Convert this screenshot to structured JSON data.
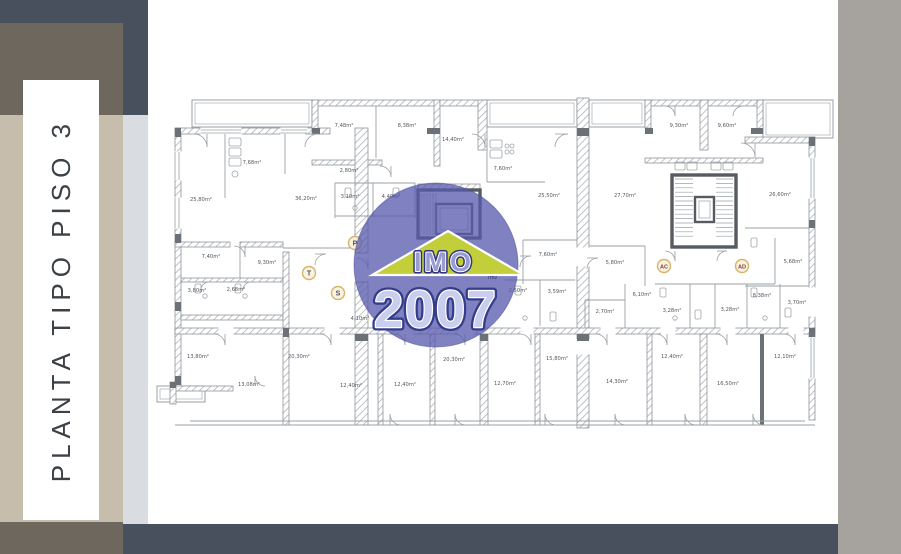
{
  "sidebar": {
    "title": "PLANTA TIPO PISO 3"
  },
  "watermark": {
    "brand_top": "IMO",
    "brand_year": "2007",
    "brand_small": "rmv",
    "circle_color": "#585aac",
    "house_color": "#c9d62f"
  },
  "plan": {
    "unit_badges": [
      {
        "label": "P",
        "x": 200,
        "y": 155,
        "text_color": "#4a4f55"
      },
      {
        "label": "T",
        "x": 154,
        "y": 185,
        "text_color": "#4a4f55"
      },
      {
        "label": "S",
        "x": 183,
        "y": 205,
        "text_color": "#4a4f55"
      },
      {
        "label": "AC",
        "x": 509,
        "y": 178,
        "text_color": "#8a3c2c"
      },
      {
        "label": "AD",
        "x": 587,
        "y": 178,
        "text_color": "#8a3c2c"
      }
    ],
    "room_labels": [
      {
        "t": "7,68m²",
        "x": 97,
        "y": 76
      },
      {
        "t": "25,80m²",
        "x": 46,
        "y": 113
      },
      {
        "t": "36,20m²",
        "x": 151,
        "y": 112
      },
      {
        "t": "7,48m²",
        "x": 189,
        "y": 39
      },
      {
        "t": "8,38m²",
        "x": 252,
        "y": 39
      },
      {
        "t": "14,40m²",
        "x": 298,
        "y": 53
      },
      {
        "t": "2,80m²",
        "x": 194,
        "y": 84
      },
      {
        "t": "3,10m²",
        "x": 195,
        "y": 110
      },
      {
        "t": "4,40m²",
        "x": 236,
        "y": 110
      },
      {
        "t": "7,60m²",
        "x": 348,
        "y": 82
      },
      {
        "t": "25,50m²",
        "x": 394,
        "y": 109
      },
      {
        "t": "27,70m²",
        "x": 470,
        "y": 109
      },
      {
        "t": "9,30m²",
        "x": 524,
        "y": 39
      },
      {
        "t": "9,60m²",
        "x": 572,
        "y": 39
      },
      {
        "t": "26,60m²",
        "x": 625,
        "y": 108
      },
      {
        "t": "7,40m²",
        "x": 56,
        "y": 170
      },
      {
        "t": "9,30m²",
        "x": 112,
        "y": 176
      },
      {
        "t": "3,80m²",
        "x": 42,
        "y": 204
      },
      {
        "t": "2,68m²",
        "x": 81,
        "y": 203
      },
      {
        "t": "7,60m²",
        "x": 393,
        "y": 168
      },
      {
        "t": "5,80m²",
        "x": 460,
        "y": 176
      },
      {
        "t": "5,68m²",
        "x": 638,
        "y": 175
      },
      {
        "t": "6,10m²",
        "x": 487,
        "y": 208
      },
      {
        "t": "3,70m²",
        "x": 642,
        "y": 216
      },
      {
        "t": "8,38m²",
        "x": 607,
        "y": 209
      },
      {
        "t": "3,28m²",
        "x": 517,
        "y": 224
      },
      {
        "t": "3,28m²",
        "x": 575,
        "y": 223
      },
      {
        "t": "2,50m²",
        "x": 363,
        "y": 204
      },
      {
        "t": "3,59m²",
        "x": 402,
        "y": 205
      },
      {
        "t": "2,70m²",
        "x": 450,
        "y": 225
      },
      {
        "t": "4,10m²",
        "x": 205,
        "y": 232
      },
      {
        "t": "4,10m²",
        "x": 242,
        "y": 232
      },
      {
        "t": "13,80m²",
        "x": 43,
        "y": 270
      },
      {
        "t": "13,08m²",
        "x": 94,
        "y": 298
      },
      {
        "t": "20,30m²",
        "x": 144,
        "y": 270
      },
      {
        "t": "12,40m²",
        "x": 196,
        "y": 299
      },
      {
        "t": "12,40m²",
        "x": 250,
        "y": 298
      },
      {
        "t": "20,30m²",
        "x": 299,
        "y": 273
      },
      {
        "t": "12,70m²",
        "x": 350,
        "y": 297
      },
      {
        "t": "15,80m²",
        "x": 402,
        "y": 272
      },
      {
        "t": "14,30m²",
        "x": 462,
        "y": 295
      },
      {
        "t": "12,40m²",
        "x": 517,
        "y": 270
      },
      {
        "t": "16,50m²",
        "x": 573,
        "y": 297
      },
      {
        "t": "12,10m²",
        "x": 630,
        "y": 270
      }
    ],
    "colors": {
      "wall_hatch": "#aeb3b9",
      "wall_edge": "#8f959b",
      "pier": "#6c7177",
      "line": "#9aa0a5",
      "core_wall": "#565b61",
      "label_text": "#54595f",
      "badge_ring": "#d7b36c",
      "badge_fill": "#f8f2e0"
    }
  }
}
